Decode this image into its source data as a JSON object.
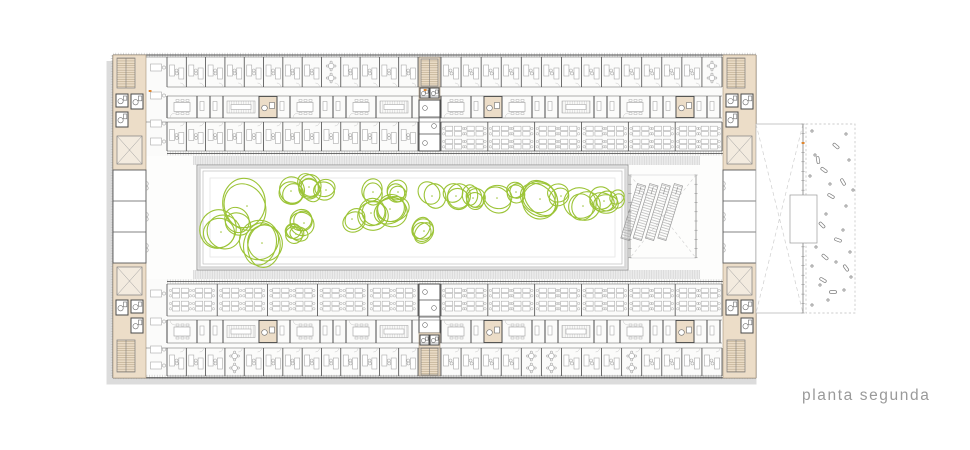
{
  "title": {
    "text": "planta segunda"
  },
  "colors": {
    "paper": "#ffffff",
    "wall": "#4a4a4a",
    "wallSoft": "#6e6e6e",
    "furniture": "#ababab",
    "lightLine": "#c6c6c6",
    "core": "#ecddc8",
    "coreEdge": "#a6937a",
    "tree": "#9cc437",
    "shadow": "#dcdcdc",
    "frame": "#9a9a9a",
    "frameFill": "#d8d8d8",
    "eave": "#ececec",
    "dash": "#cfcfcf",
    "text": "#9a9a9a",
    "accent": "#e0862e"
  },
  "plan": {
    "canvas": {
      "w": 970,
      "h": 450
    },
    "building": {
      "x": 113,
      "y": 55,
      "w": 643,
      "h": 323
    },
    "wings": {
      "top": {
        "row1": [
          57,
          87
        ],
        "mid": [
          96,
          118
        ],
        "row3": [
          122,
          151
        ],
        "facadeY": 153,
        "eave": [
          156,
          165
        ]
      },
      "bottom": {
        "eave": [
          270,
          279
        ],
        "facadeY": 281,
        "open": [
          284,
          316
        ],
        "mid": [
          320,
          343
        ],
        "rowC": [
          348,
          376
        ]
      },
      "spanLeft": [
        167,
        418
      ],
      "spanRight": [
        441,
        722
      ],
      "cellWidth": 19.5,
      "openBay": 47,
      "serviceCells": [
        185,
        258,
        488,
        672
      ],
      "copyRooms": [
        228,
        370,
        560
      ],
      "roundTablesTop": [
        333,
        710
      ],
      "roundTablesBottom": [
        237,
        540,
        630
      ]
    },
    "cores": {
      "left": {
        "x": 113,
        "w": 33,
        "topY": 55,
        "topH": 115,
        "botY": 263,
        "botH": 115
      },
      "right": {
        "x": 723,
        "w": 33,
        "topY": 55,
        "topH": 115,
        "botY": 263,
        "botH": 115
      },
      "midTop": {
        "x": 418,
        "w": 23,
        "y0": 57,
        "y1": 152
      },
      "midBot": {
        "x": 418,
        "w": 23,
        "y0": 284,
        "y1": 376
      }
    },
    "midRooms": {
      "yTop": 170,
      "yBot": 263,
      "dividers": [
        201,
        232
      ]
    },
    "courtyard": {
      "x": 197,
      "y": 165,
      "w": 431,
      "h": 105
    },
    "stair": {
      "x": 630,
      "y": 175,
      "w": 66,
      "h": 83,
      "bands": 4,
      "bandAngle": 17
    },
    "annex": {
      "void": {
        "x": 756,
        "y": 124,
        "w": 47,
        "h": 189
      },
      "tickX": 803,
      "platform": {
        "x": 790,
        "y": 195,
        "w": 27,
        "h": 48
      },
      "garden": {
        "x": 806,
        "y": 124,
        "w": 49,
        "h": 189
      }
    },
    "trees": [
      [
        247,
        206,
        26
      ],
      [
        221,
        232,
        19
      ],
      [
        262,
        243,
        21
      ],
      [
        236,
        221,
        14
      ],
      [
        291,
        191,
        13
      ],
      [
        309,
        187,
        12
      ],
      [
        326,
        190,
        11
      ],
      [
        304,
        223,
        12
      ],
      [
        296,
        234,
        9
      ],
      [
        352,
        219,
        12
      ],
      [
        371,
        213,
        15
      ],
      [
        390,
        209,
        16
      ],
      [
        373,
        192,
        12
      ],
      [
        398,
        192,
        10
      ],
      [
        424,
        231,
        11
      ],
      [
        432,
        196,
        13
      ],
      [
        456,
        196,
        12
      ],
      [
        473,
        198,
        10
      ],
      [
        497,
        198,
        15
      ],
      [
        516,
        192,
        9
      ],
      [
        540,
        199,
        19
      ],
      [
        561,
        196,
        11
      ],
      [
        583,
        206,
        16
      ],
      [
        604,
        201,
        12
      ],
      [
        616,
        198,
        8
      ]
    ],
    "gardenDots": [
      [
        812,
        131
      ],
      [
        846,
        134
      ],
      [
        815,
        155
      ],
      [
        849,
        160
      ],
      [
        810,
        176
      ],
      [
        830,
        184
      ],
      [
        853,
        190
      ],
      [
        812,
        203
      ],
      [
        846,
        206
      ],
      [
        826,
        214
      ],
      [
        810,
        233
      ],
      [
        843,
        230
      ],
      [
        816,
        247
      ],
      [
        850,
        252
      ],
      [
        812,
        266
      ],
      [
        836,
        262
      ],
      [
        851,
        277
      ],
      [
        820,
        285
      ],
      [
        844,
        290
      ],
      [
        828,
        300
      ],
      [
        812,
        305
      ]
    ],
    "gardenPods": [
      [
        836,
        146,
        40
      ],
      [
        824,
        170,
        35
      ],
      [
        843,
        182,
        60
      ],
      [
        831,
        196,
        30
      ],
      [
        822,
        225,
        45
      ],
      [
        838,
        240,
        20
      ],
      [
        825,
        257,
        40
      ],
      [
        846,
        268,
        55
      ],
      [
        823,
        280,
        30
      ],
      [
        833,
        292,
        0
      ],
      [
        818,
        160,
        80
      ]
    ],
    "accents": [
      [
        150,
        91
      ],
      [
        425,
        90
      ],
      [
        803,
        143
      ]
    ],
    "corridorDesksTop": [
      64,
      92,
      120,
      138
    ],
    "corridorDesksBottom": [
      290,
      318,
      346,
      362
    ]
  }
}
